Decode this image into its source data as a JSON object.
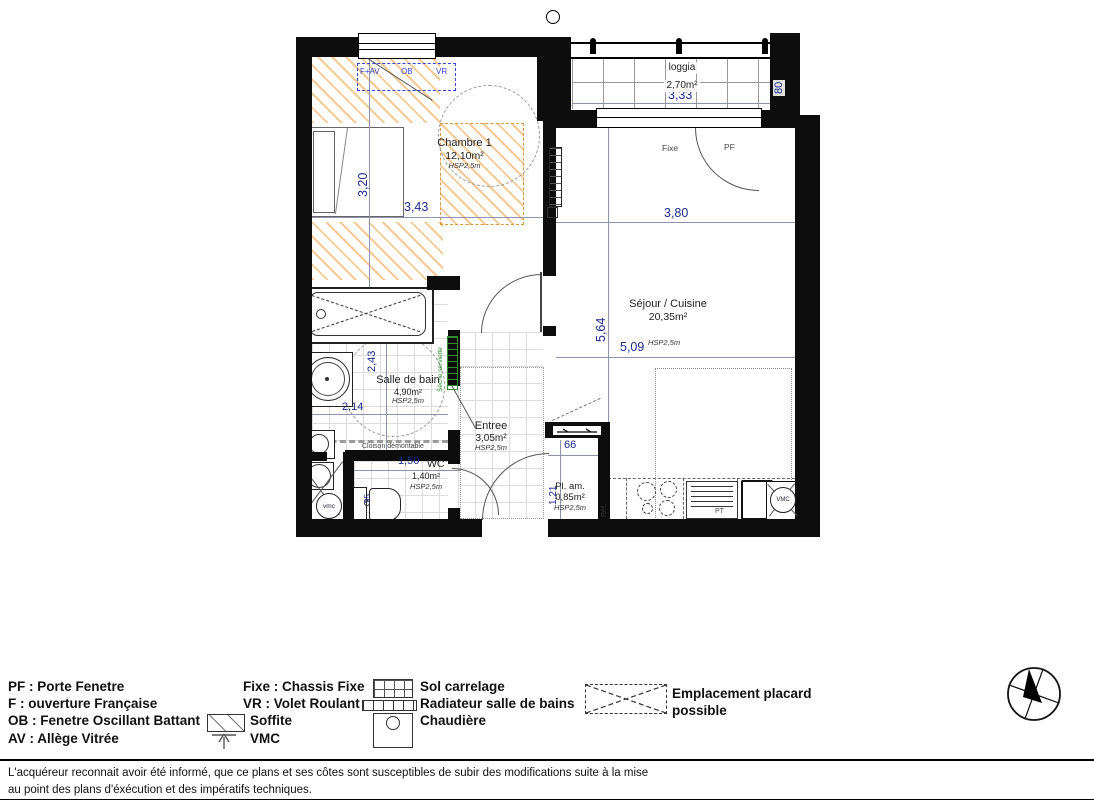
{
  "plan": {
    "rooms": {
      "chambre": {
        "name": "Chambre 1",
        "area": "12,10m²",
        "height": "HSP2,5m"
      },
      "loggia": {
        "name": "loggia",
        "area": "2,70m²"
      },
      "sejour": {
        "name": "Séjour / Cuisine",
        "area": "20,35m²",
        "height": "HSP2,5m"
      },
      "salle_de_bain": {
        "name": "Salle de bain",
        "area": "4,90m²",
        "height": "HSP2,5m"
      },
      "entree": {
        "name": "Entree",
        "area": "3,05m²",
        "height": "HSP2,5m"
      },
      "wc": {
        "name": "WC",
        "area": "1,40m²",
        "height": "HSP2,5m"
      },
      "placard": {
        "name": "Pl. am.",
        "area": "0,85m²",
        "height": "HSP2,5m"
      }
    },
    "dimensions": {
      "chambre_width": "3,43",
      "chambre_depth": "3,20",
      "loggia_width": "3,33",
      "loggia_depth": "80",
      "sejour_width_top": "3,80",
      "sejour_depth": "5,64",
      "sejour_width": "5,09",
      "sdb_depth": "2,43",
      "sdb_width": "2,14",
      "wc_width": "1,50",
      "wc_depth": "95",
      "placard_width": "66",
      "placard_depth": "1,21"
    },
    "annotations": {
      "window_left": "F+AV",
      "window_mid": "OB",
      "window_right": "VR",
      "fixe": "Fixe",
      "pf": "PF",
      "cloison": "Cloison démontable",
      "seche_serviette": "Sèche serviette",
      "vmc_small": "vmc",
      "vmc_kitchen": "VMC",
      "ref": "Réf.",
      "pt": "PT"
    }
  },
  "legend": {
    "abbreviations": [
      "PF : Porte Fenetre",
      "F : ouverture Française",
      "OB : Fenetre Oscillant Battant",
      "AV : Allège Vitrée"
    ],
    "windows": [
      "Fixe : Chassis Fixe",
      "VR : Volet Roulant",
      "Soffite",
      "VMC"
    ],
    "symbols": [
      "Sol carrelage",
      "Radiateur salle de bains",
      "Chaudière"
    ],
    "placard": "Emplacement placard possible"
  },
  "disclaimer": "L'acquéreur reconnait avoir été informé, que ce plans et ses côtes sont susceptibles de subir des modifications suite à la mise au point des plans d'éxécution et des impératifs techniques.",
  "colors": {
    "wall": "#0d0d0d",
    "soffite_hatch": "#f0a64d",
    "annotation_blue": "#3844cc",
    "dimension_navy": "#1c2b8c",
    "radiator_green": "#2e8b2e"
  }
}
